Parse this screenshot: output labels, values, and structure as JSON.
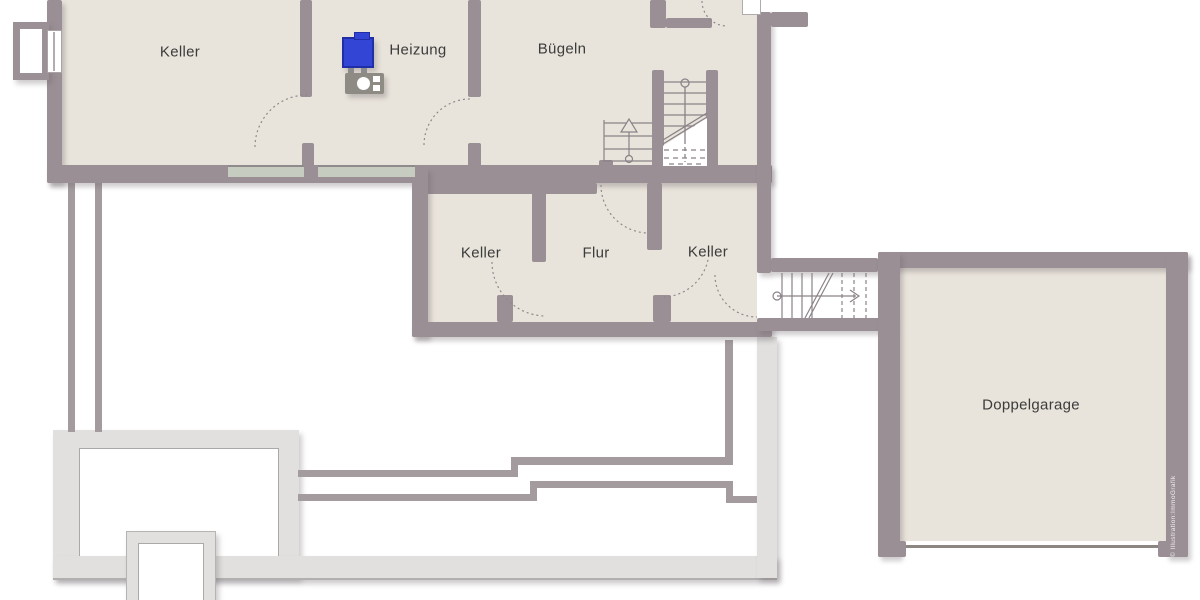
{
  "rooms": [
    {
      "id": "keller_top",
      "label": "Keller"
    },
    {
      "id": "heizung",
      "label": "Heizung"
    },
    {
      "id": "buegeln",
      "label": "Bügeln"
    },
    {
      "id": "keller_left",
      "label": "Keller"
    },
    {
      "id": "flur",
      "label": "Flur"
    },
    {
      "id": "keller_right",
      "label": "Keller"
    },
    {
      "id": "doppelgarage",
      "label": "Doppelgarage"
    }
  ],
  "watermark": "© Illustration:ImmoGrafik",
  "colors": {
    "room_fill": "#e9e4db",
    "wall": "#998f94",
    "outdoor_light": "#e1e0de",
    "outdoor_line": "#a39b9e",
    "window_strip": "#c7ccc0",
    "stair_line": "#8a8288",
    "heater_blue": "#3345d5",
    "label_text": "#3b3b3b"
  }
}
